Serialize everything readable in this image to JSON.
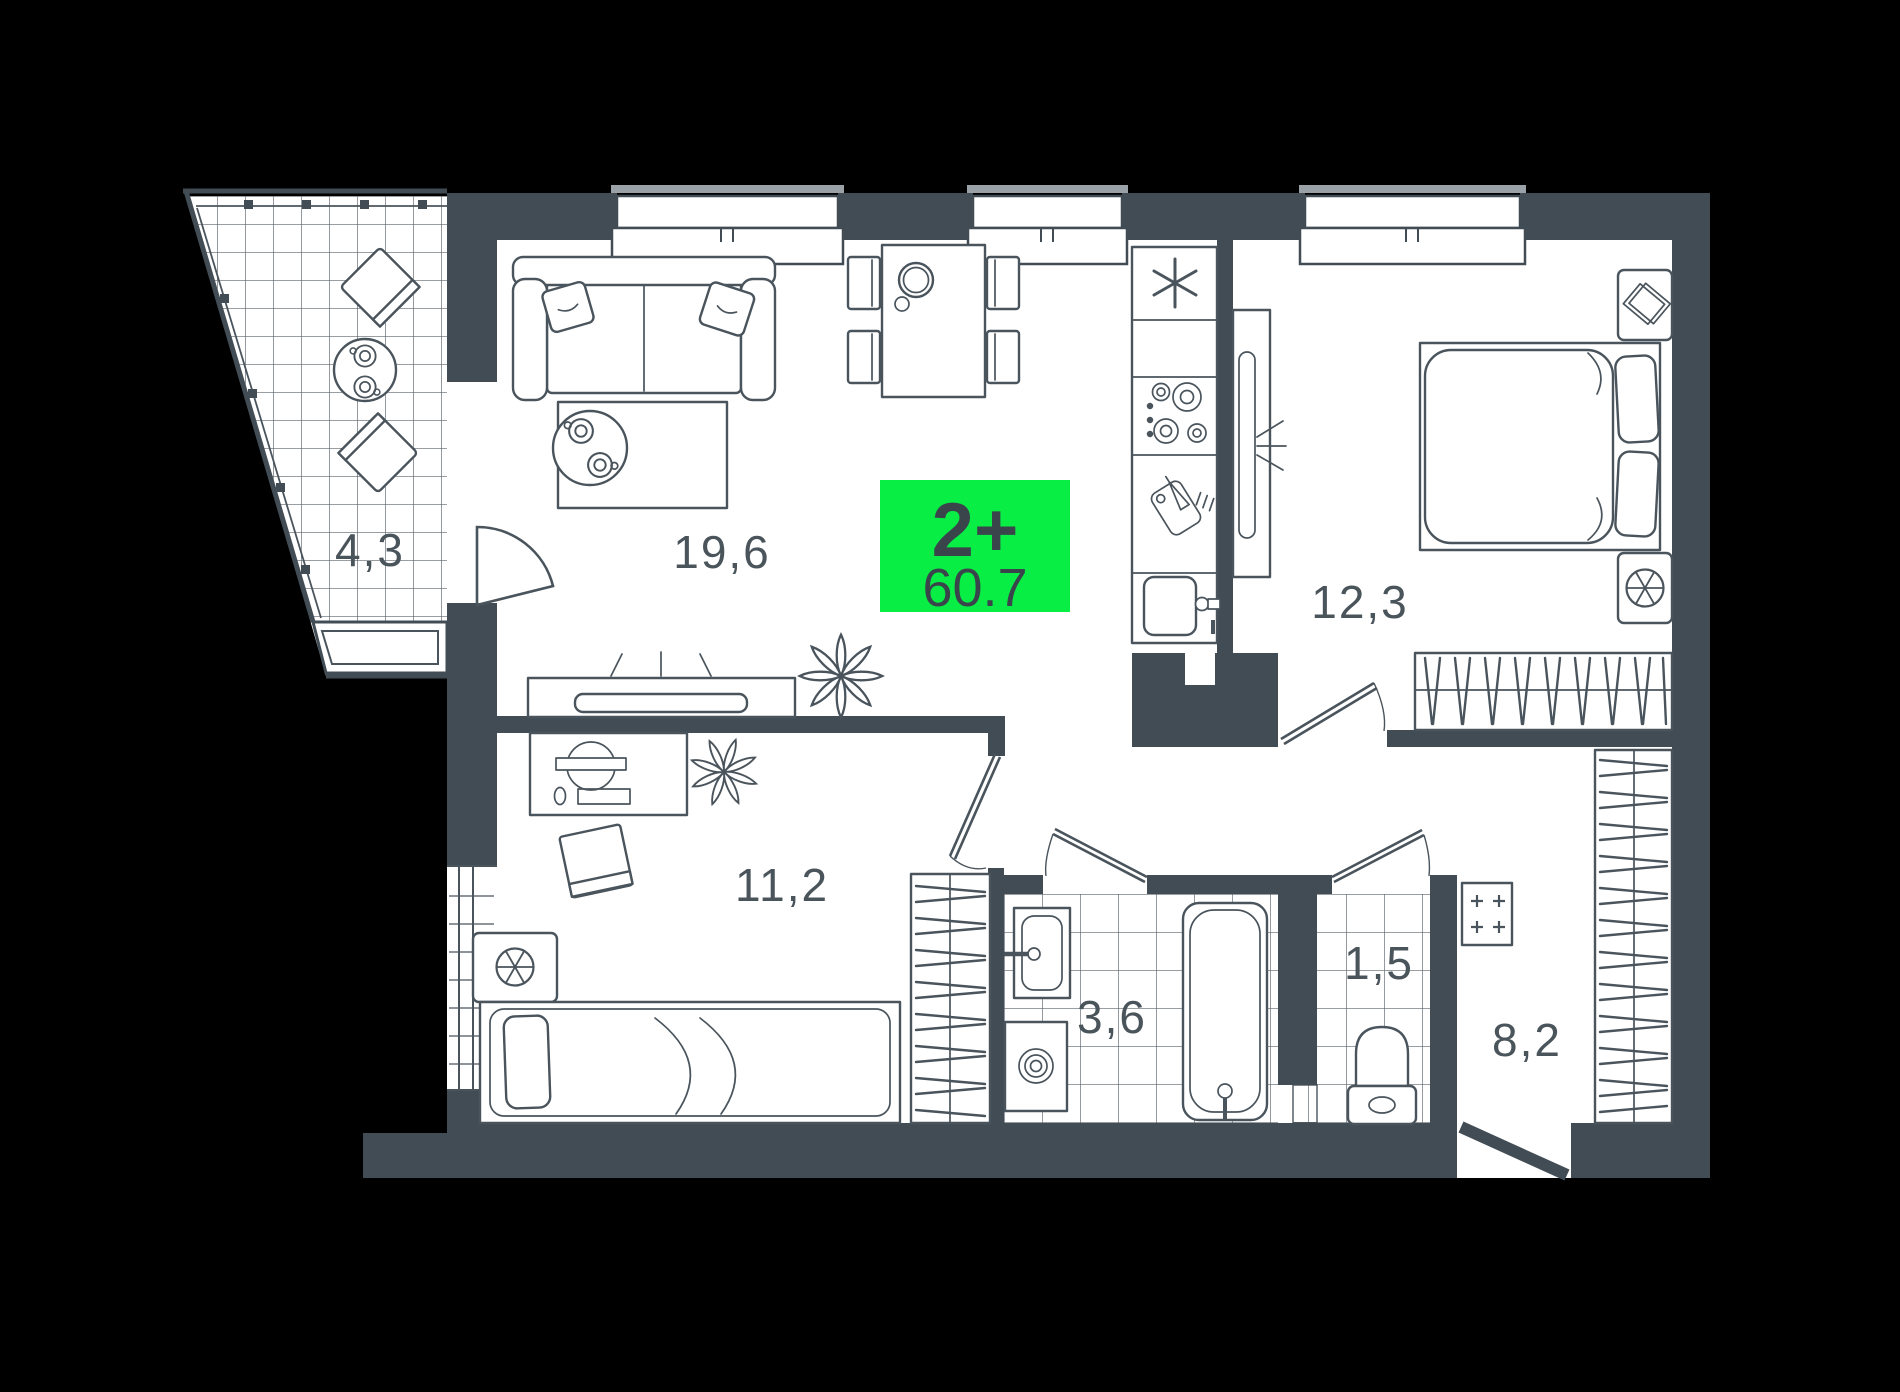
{
  "badge": {
    "room_type": "2+",
    "total_area": "60.7"
  },
  "rooms": {
    "balcony": {
      "name": "balcony",
      "area": "4,3"
    },
    "living_room": {
      "name": "living-room",
      "area": "19,6"
    },
    "bedroom": {
      "name": "bedroom",
      "area": "11,2"
    },
    "master_bedroom": {
      "name": "master-bedroom",
      "area": "12,3"
    },
    "bathroom": {
      "name": "bathroom",
      "area": "3,6"
    },
    "toilet": {
      "name": "toilet",
      "area": "1,5"
    },
    "hallway": {
      "name": "hallway",
      "area": "8,2"
    }
  },
  "colors": {
    "background": "#000000",
    "wall": "#424C54",
    "furniture_line": "#4A545C",
    "tile_line": "#5A646B",
    "window_ledge": "#9AA1A7",
    "badge_bg": "#08EE45",
    "badge_text": "#3A444B",
    "label_text": "#4A545B"
  }
}
